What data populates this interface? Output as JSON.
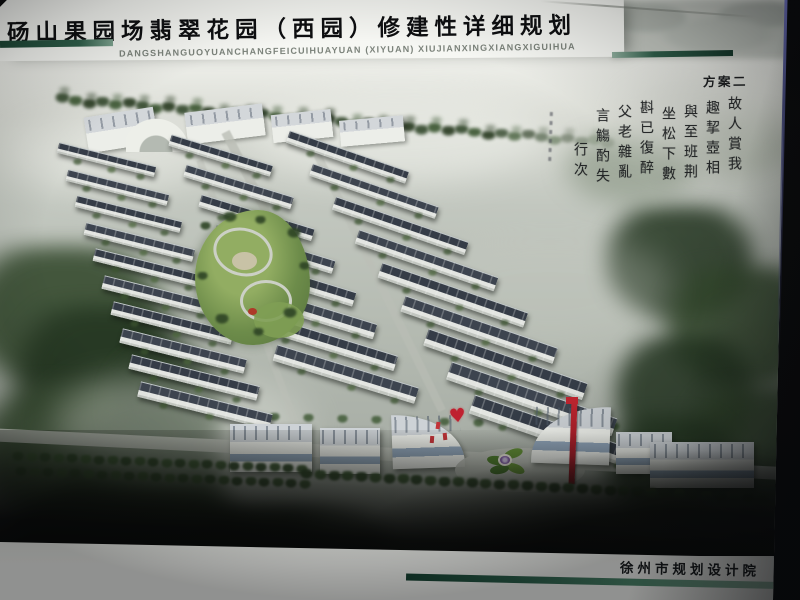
{
  "photo": {
    "frame_color": "#0a0a0c",
    "edge_highlight_color": "#7b7fd8"
  },
  "header": {
    "title": "砀山果园场翡翠花园（西园）修建性详细规划",
    "pinyin": "DANGSHANGUOYUANCHANGFEICUIHUAYUAN (XIYUAN) XIUJIANXINGXIANGXIGUIHUA",
    "plan_label": "方案二",
    "rule_color_dark": "#16402f",
    "rule_color_light": "#8fae9d"
  },
  "rendering": {
    "colors": {
      "mist_light": "#e9ebe5",
      "mist_mid": "#bcc1b9",
      "forest_dark": "#243621",
      "forest_mid": "#33482c",
      "tree_line": "#3a5530",
      "roof": "#3d444f",
      "wall": "#e3e5e1",
      "road": "#bcbfb7",
      "lawn_light": "#92ad62",
      "lawn_dark": "#55713c",
      "plaza": "#c7c1a6",
      "window_blue": "#7089a6",
      "accent_red": "#bf2130",
      "flower_purple": "#7d58a2",
      "petal_green": "#4e7c2c"
    },
    "icons": {
      "heart": "♥"
    }
  },
  "calligraphy": {
    "columns": [
      "故人賞我",
      "趣挈壺相",
      "與至班荆",
      "坐松下數",
      "斟已復醉",
      "父老雜亂",
      "言觴酌失",
      "行次"
    ]
  },
  "footer": {
    "institute": "徐州市规划设计院",
    "bar_gradient": [
      "#13402f",
      "#2a604a",
      "#4e8a6d",
      "#aecfbc"
    ]
  }
}
